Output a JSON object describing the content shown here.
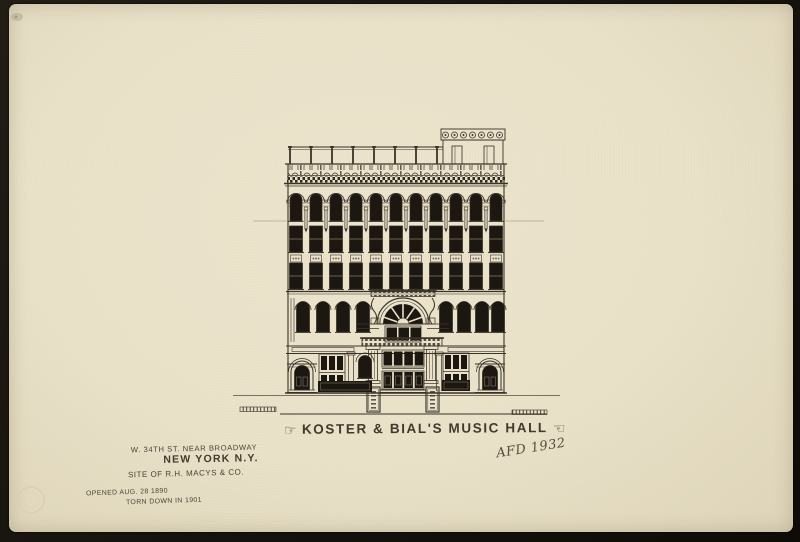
{
  "photo": {
    "border_color": "#17130e"
  },
  "paper": {
    "color": "#e9e1c8",
    "ink_color": "#3a3328"
  },
  "captions": {
    "manicule_right_pointing": "☞",
    "title": "KOSTER & BIAL'S MUSIC HALL",
    "manicule_left_pointing": "☜",
    "signature": "AFD 1932",
    "address_line1": "W. 34TH ST. NEAR BROADWAY",
    "address_line2": "NEW YORK N.Y.",
    "site_line": "SITE OF R.H. MACYS & CO.",
    "opened_line": "OPENED AUG. 28 1890",
    "torn_down_line": "TORN DOWN IN 1901"
  }
}
